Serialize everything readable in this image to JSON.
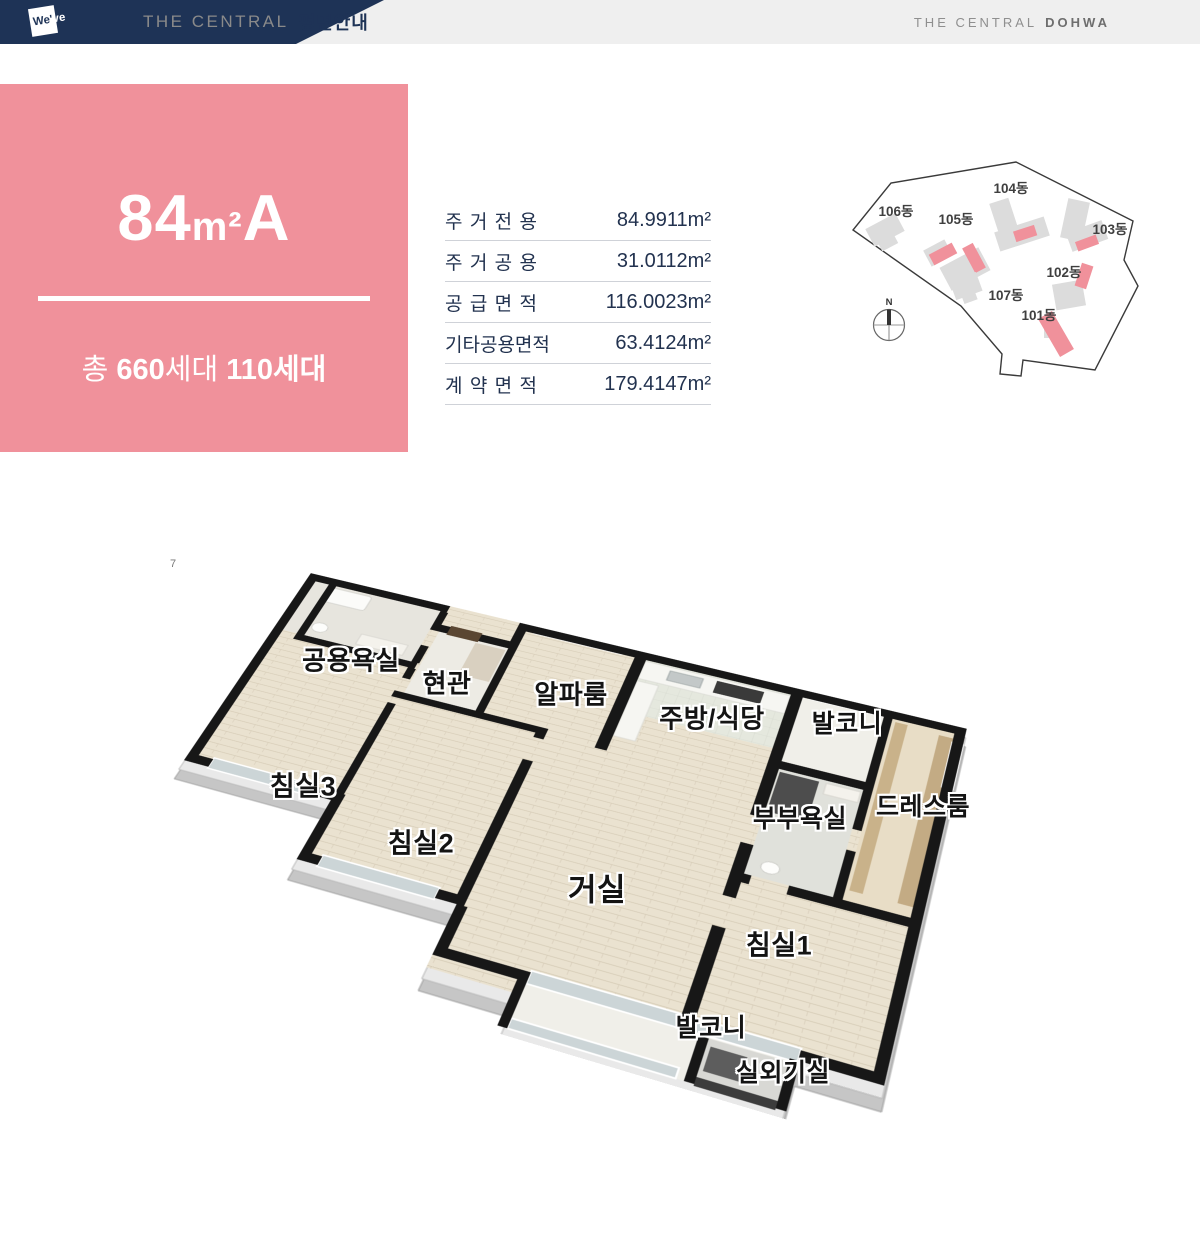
{
  "header": {
    "logo_a": "We'",
    "logo_b": "ve",
    "brand_left": "THE CENTRAL",
    "brand_left_bold": "평면안내",
    "brand_right": "THE CENTRAL",
    "brand_right_bold": "DOHWA"
  },
  "unit": {
    "title_num": "84",
    "title_mid": "m²",
    "title_type": "A",
    "sub_parts": [
      {
        "text": "총 ",
        "bold": false
      },
      {
        "text": "660",
        "bold": true
      },
      {
        "text": "세대 ",
        "bold": false
      },
      {
        "text": "110세대",
        "bold": true
      }
    ]
  },
  "area_table": {
    "rows": [
      {
        "label": "주거전용",
        "value": "84.9911m²",
        "spread": true
      },
      {
        "label": "주거공용",
        "value": "31.0112m²",
        "spread": true
      },
      {
        "label": "공급면적",
        "value": "116.0023m²",
        "spread": true
      },
      {
        "label": "기타공용면적",
        "value": "63.4124m²",
        "spread": false
      },
      {
        "label": "계약면적",
        "value": "179.4147m²",
        "spread": true
      }
    ]
  },
  "site_plan": {
    "compass_label": "N",
    "building_labels": [
      {
        "text": "106동",
        "x": 48,
        "y": 68
      },
      {
        "text": "105동",
        "x": 108,
        "y": 76
      },
      {
        "text": "104동",
        "x": 163,
        "y": 45
      },
      {
        "text": "103동",
        "x": 262,
        "y": 86
      },
      {
        "text": "102동",
        "x": 216,
        "y": 129
      },
      {
        "text": "101동",
        "x": 191,
        "y": 172
      },
      {
        "text": "107동",
        "x": 158,
        "y": 152
      }
    ]
  },
  "floor_plan": {
    "watermark": "7",
    "labels": [
      {
        "text": "공용욕실",
        "x": 351,
        "y": 659,
        "size": 26
      },
      {
        "text": "현관",
        "x": 447,
        "y": 682,
        "size": 26
      },
      {
        "text": "알파룸",
        "x": 571,
        "y": 693,
        "size": 26
      },
      {
        "text": "주방/식당",
        "x": 712,
        "y": 717,
        "size": 26
      },
      {
        "text": "발코니",
        "x": 847,
        "y": 722,
        "size": 25
      },
      {
        "text": "침실3",
        "x": 303,
        "y": 784,
        "size": 27
      },
      {
        "text": "침실2",
        "x": 421,
        "y": 841,
        "size": 27
      },
      {
        "text": "부부욕실",
        "x": 800,
        "y": 817,
        "size": 25
      },
      {
        "text": "드레스룸",
        "x": 923,
        "y": 805,
        "size": 25
      },
      {
        "text": "거실",
        "x": 597,
        "y": 887,
        "size": 31
      },
      {
        "text": "침실1",
        "x": 779,
        "y": 943,
        "size": 27
      },
      {
        "text": "발코니",
        "x": 711,
        "y": 1026,
        "size": 25
      },
      {
        "text": "실외기실",
        "x": 783,
        "y": 1071,
        "size": 25
      }
    ]
  },
  "colors": {
    "navy": "#1e3356",
    "pink": "#f0919b",
    "headerBg": "#efefef",
    "headerGray": "#8a8a8a",
    "rightGray": "#8f8f8f",
    "tableText": "#22324f",
    "line": "#cfd2d8",
    "wall": "#171717",
    "wood": "#eae2d0",
    "slab": "#c6c6c6",
    "slabLight": "#e9e9e9",
    "glass": "#ccd5d7",
    "siteGray": "#dcdcdc",
    "labelInk": "#141414"
  }
}
